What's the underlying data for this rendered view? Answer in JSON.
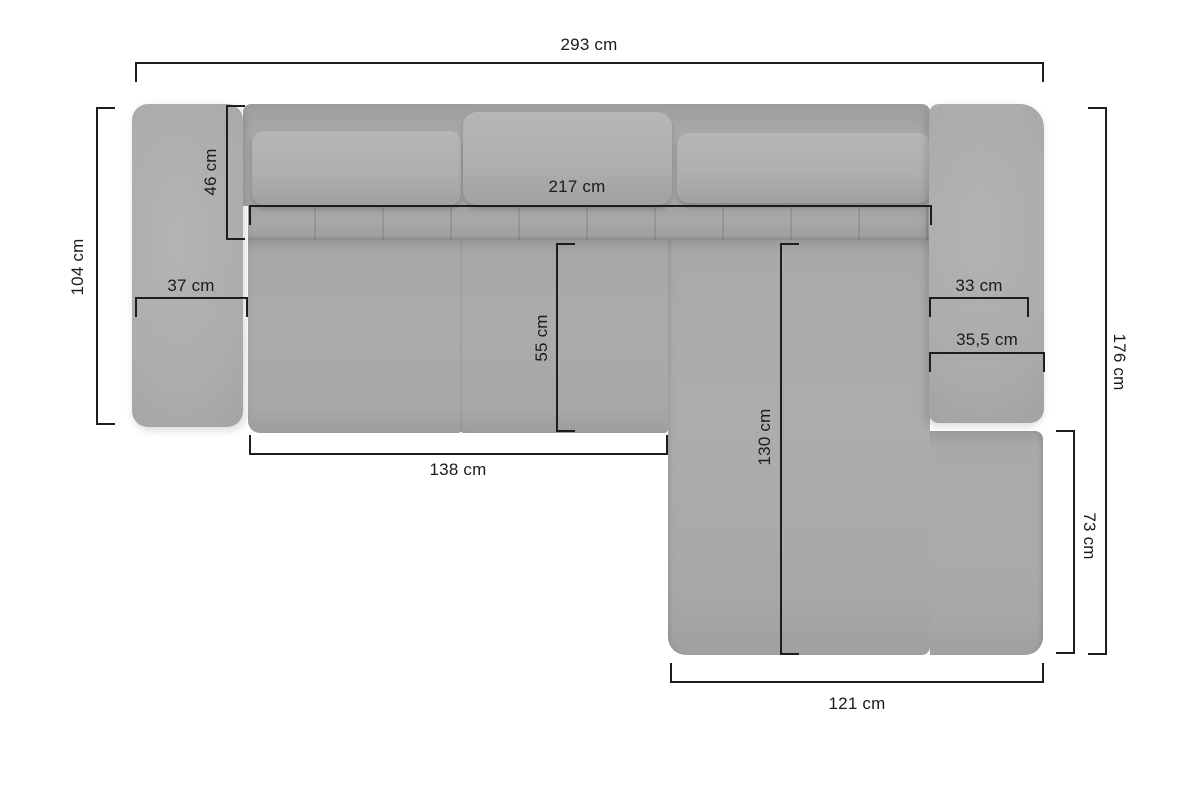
{
  "diagram": {
    "type": "furniture-dimension-diagram",
    "subject": "corner sofa with chaise longue, top view",
    "unit": "cm",
    "colors": {
      "background": "#ffffff",
      "sofa_fill": "#a9a9a9",
      "pillow_fill": "#b0b0b0",
      "shadow": "#9a9a9a",
      "dimension_line": "#1d1d1d",
      "label_text": "#1b1b1b"
    },
    "dimensions": {
      "total_width": {
        "label": "293 cm",
        "value": 293
      },
      "left_side_depth": {
        "label": "104 cm",
        "value": 104
      },
      "backrest_depth": {
        "label": "46 cm",
        "value": 46
      },
      "seat_width": {
        "label": "217 cm",
        "value": 217
      },
      "left_armrest_width": {
        "label": "37 cm",
        "value": 37
      },
      "right_armrest_inner_width": {
        "label": "33 cm",
        "value": 33
      },
      "right_armrest_outer_width": {
        "label": "35,5 cm",
        "value": 35.5
      },
      "seat_depth": {
        "label": "55 cm",
        "value": 55
      },
      "seat_front_width": {
        "label": "138 cm",
        "value": 138
      },
      "chaise_length": {
        "label": "130 cm",
        "value": 130
      },
      "total_depth": {
        "label": "176 cm",
        "value": 176
      },
      "chaise_side_depth": {
        "label": "73 cm",
        "value": 73
      },
      "chaise_width": {
        "label": "121 cm",
        "value": 121
      }
    }
  }
}
